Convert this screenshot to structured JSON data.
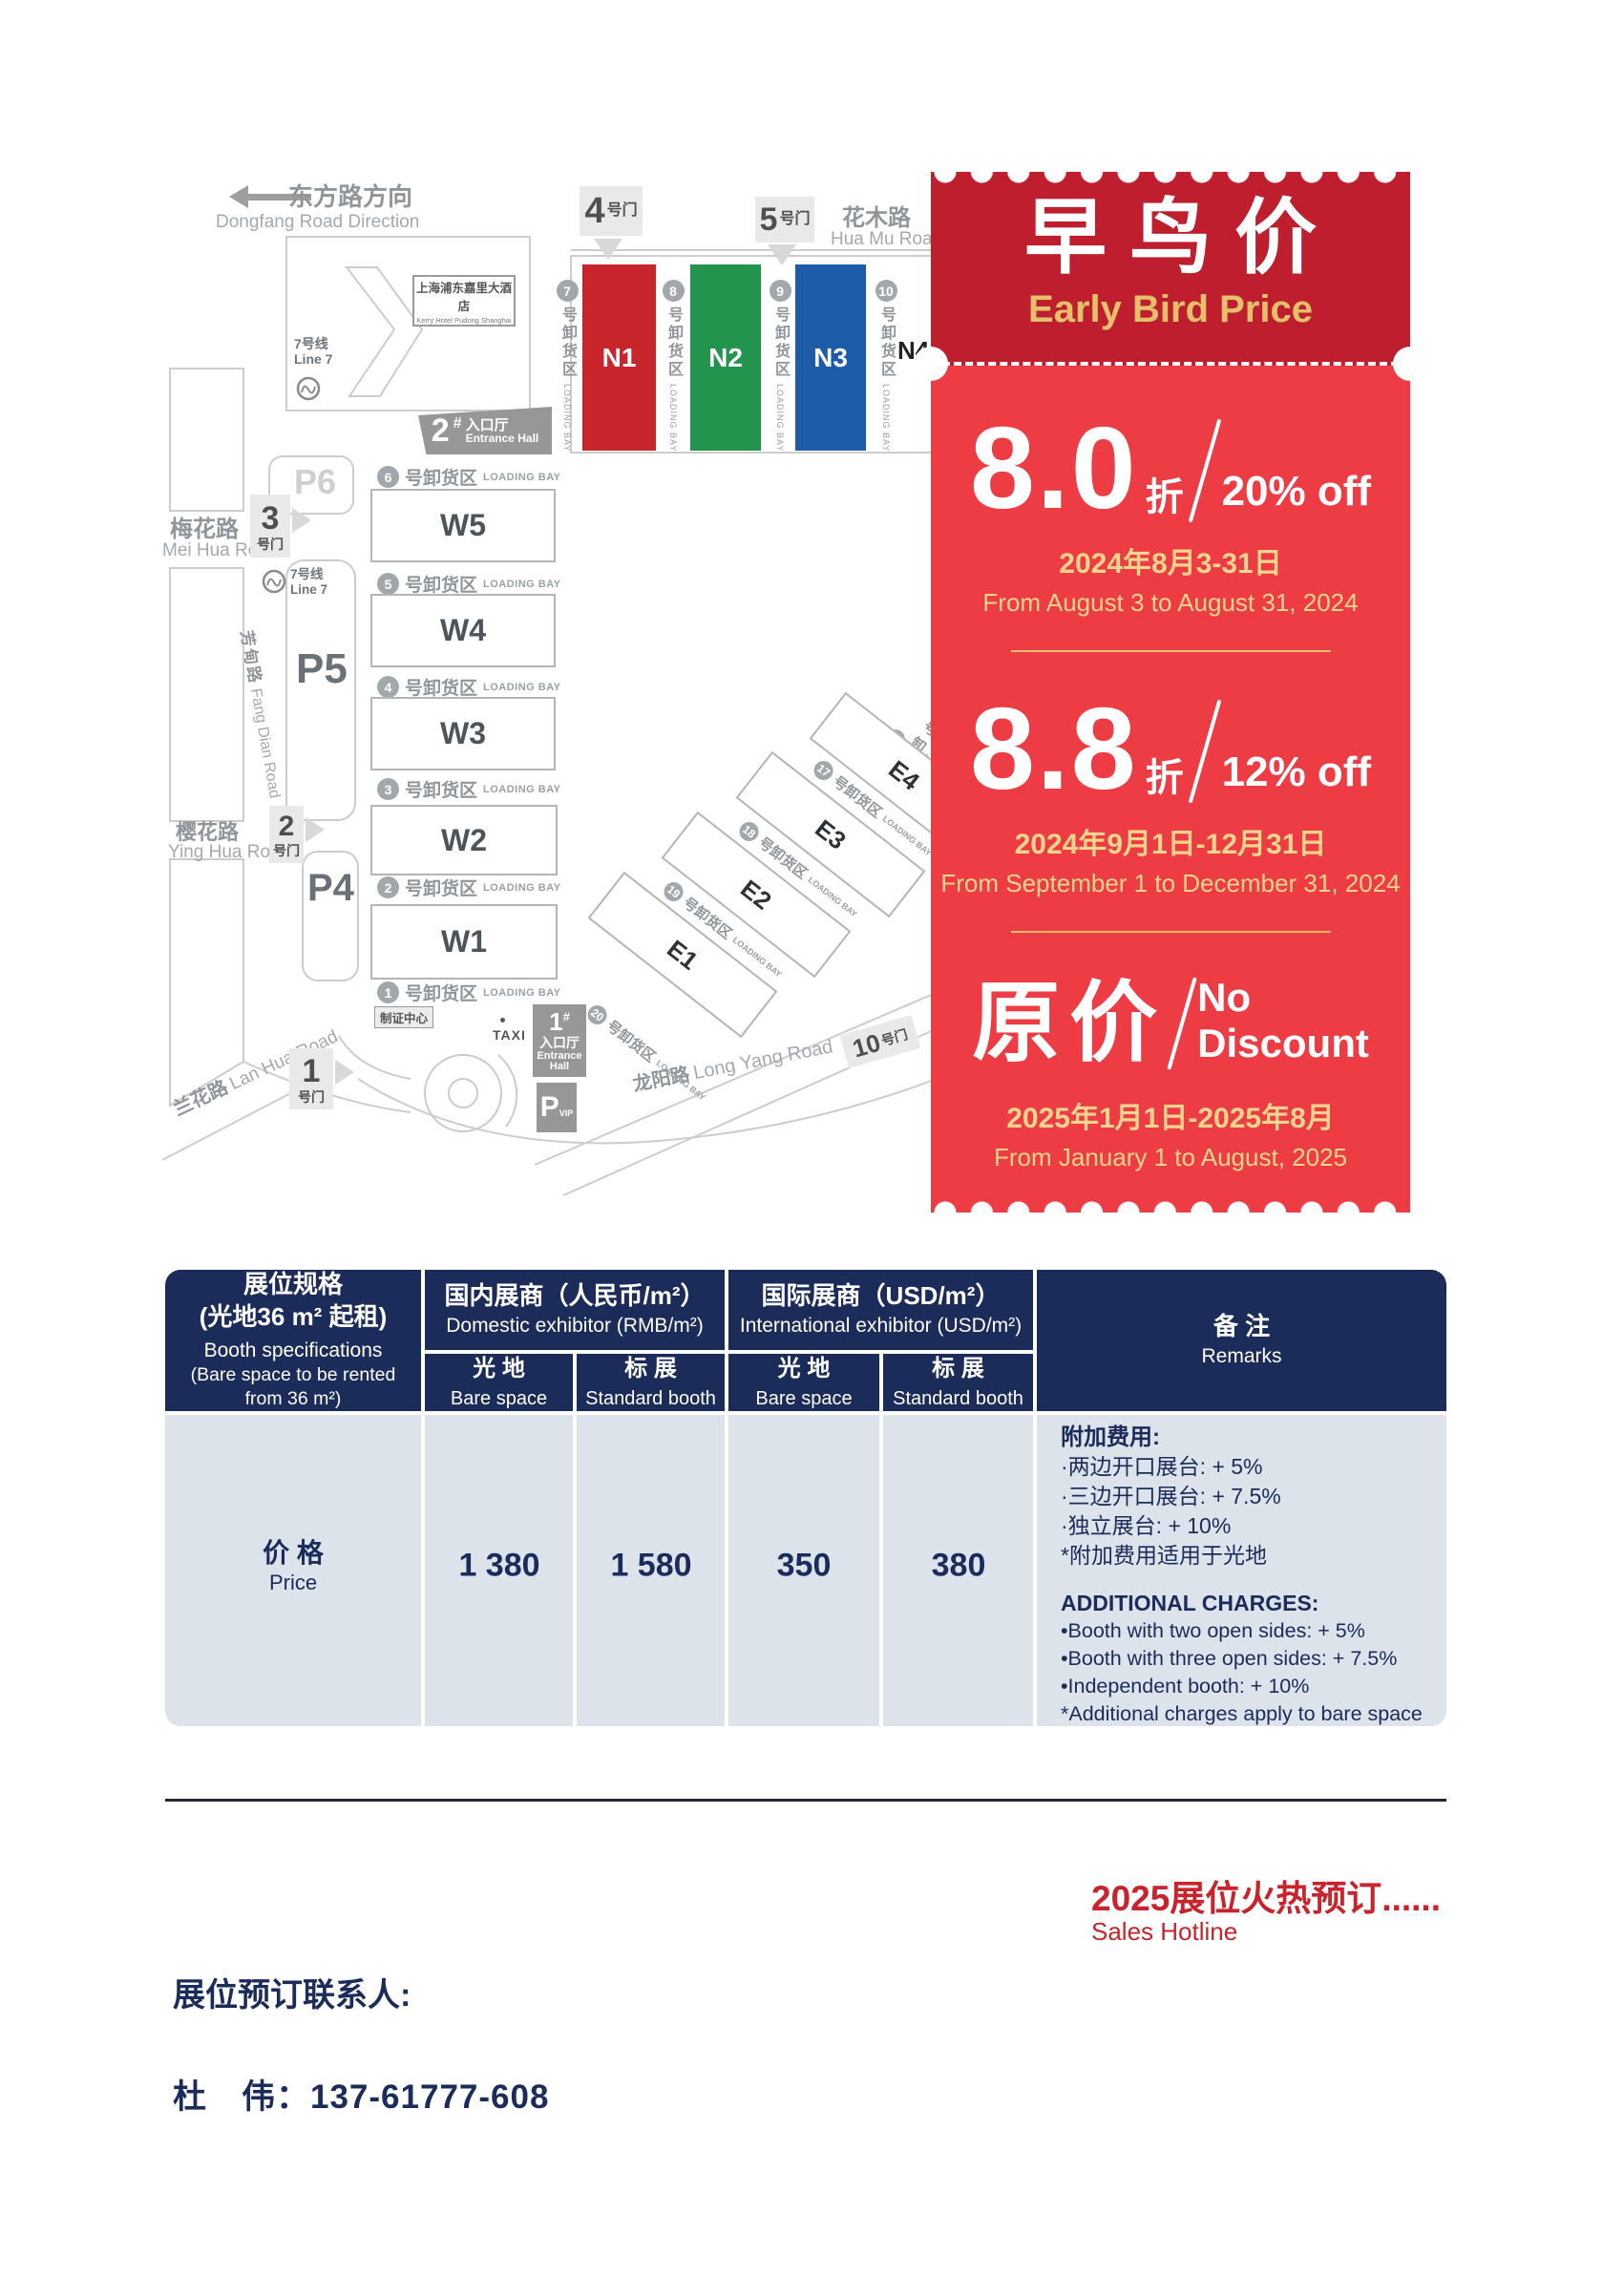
{
  "map": {
    "roads": {
      "dongfang": {
        "cn": "东方路方向",
        "en": "Dongfang Road Direction"
      },
      "huamu": {
        "cn": "花木路",
        "en": "Hua Mu Road"
      },
      "meihua": {
        "cn": "梅花路",
        "en": "Mei Hua Road"
      },
      "yinghua": {
        "cn": "樱花路",
        "en": "Ying Hua Road"
      },
      "lanhua": {
        "cn": "兰花路",
        "en": "Lan Hua Road"
      },
      "fangdian": {
        "cn": "芳甸路",
        "en": "Fang Dian Road"
      },
      "longyang": {
        "cn": "龙阳路",
        "en": "Long Yang Road"
      }
    },
    "gate_suffix": "号门",
    "gates": {
      "g1": "1",
      "g2": "2",
      "g3": "3",
      "g4": "4",
      "g5": "5",
      "g10": "10"
    },
    "hotel": {
      "cn": "上海浦东嘉里大酒店",
      "en": "Kerry Hotel Pudong Shanghai"
    },
    "metro": {
      "cn": "7号线",
      "en": "Line 7"
    },
    "parking": {
      "p6": "P6",
      "p5": "P5",
      "p4": "P4",
      "vip": "P",
      "vip_sub": "VIP"
    },
    "entrances": {
      "e2": {
        "num": "2",
        "hash": "#",
        "hall_cn": "入口厅",
        "hall_en": "Entrance Hall"
      },
      "e1": {
        "num": "1",
        "hash": "#",
        "hall_cn": "入口厅",
        "hall_en": "Entrance Hall"
      }
    },
    "badge_center": "制证中心",
    "taxi": "TAXI",
    "bay_cn": "号卸货区",
    "bay_en": "LOADING BAY",
    "halls_n": [
      {
        "name": "N1",
        "color": "#c8252c"
      },
      {
        "name": "N2",
        "color": "#23944e"
      },
      {
        "name": "N3",
        "color": "#1c5ca8"
      },
      {
        "name": "N4",
        "color": "#c8252c"
      }
    ],
    "halls_w": [
      "W5",
      "W4",
      "W3",
      "W2",
      "W1"
    ],
    "halls_e": [
      "E4",
      "E3",
      "E2",
      "E1"
    ],
    "bays_n": [
      "7",
      "8",
      "9",
      "10"
    ],
    "bays_w": [
      "6",
      "5",
      "4",
      "3",
      "2",
      "1"
    ],
    "bays_e": [
      "16",
      "17",
      "18",
      "19",
      "20"
    ]
  },
  "coupon": {
    "title_cn": "早鸟价",
    "title_en": "Early Bird Price",
    "colors": {
      "header": "#bf1e2e",
      "body": "#ee3c44",
      "gold": "#e5c06c",
      "date_gold": "#f3d58e"
    },
    "tiers": [
      {
        "value": "8.0",
        "unit": "折",
        "off": "20% off",
        "date_cn": "2024年8月3-31日",
        "date_en": "From August 3 to August 31, 2024"
      },
      {
        "value": "8.8",
        "unit": "折",
        "off": "12% off",
        "date_cn": "2024年9月1日-12月31日",
        "date_en": "From September 1 to December 31, 2024"
      },
      {
        "value_cn": "原价",
        "off_line1": "No",
        "off_line2": "Discount",
        "date_cn": "2025年1月1日-2025年8月",
        "date_en": "From January 1 to August, 2025"
      }
    ]
  },
  "table": {
    "spec": {
      "l1": "展位规格",
      "l2": "(光地36 m² 起租)",
      "l3": "Booth specifications",
      "l4": "(Bare space to be rented",
      "l5": "from 36 m²)"
    },
    "group_domestic": {
      "cn": "国内展商（人民币/m²）",
      "en": "Domestic exhibitor (RMB/m²)"
    },
    "group_intl": {
      "cn": "国际展商（USD/m²）",
      "en": "International exhibitor (USD/m²)"
    },
    "col_bare": {
      "cn": "光 地",
      "en": "Bare space"
    },
    "col_std": {
      "cn": "标 展",
      "en": "Standard booth"
    },
    "remarks_header": {
      "cn": "备 注",
      "en": "Remarks"
    },
    "price_row": {
      "cn": "价 格",
      "en": "Price",
      "values": [
        "1 380",
        "1 580",
        "350",
        "380"
      ]
    },
    "remarks_cn": [
      "附加费用:",
      "·两边开口展台: + 5%",
      "·三边开口展台: + 7.5%",
      "·独立展台: + 10%",
      "*附加费用适用于光地"
    ],
    "remarks_en": [
      "ADDITIONAL CHARGES:",
      "•Booth with two open sides: + 5%",
      "•Booth with three open sides: + 7.5%",
      "•Independent booth: + 10%",
      "*Additional charges apply to bare space"
    ]
  },
  "footer": {
    "hotline_cn": "2025展位火热预订......",
    "hotline_en": "Sales Hotline",
    "contact_label": "展位预订联系人:",
    "contact_phone": "杜　伟：137-61777-608"
  }
}
